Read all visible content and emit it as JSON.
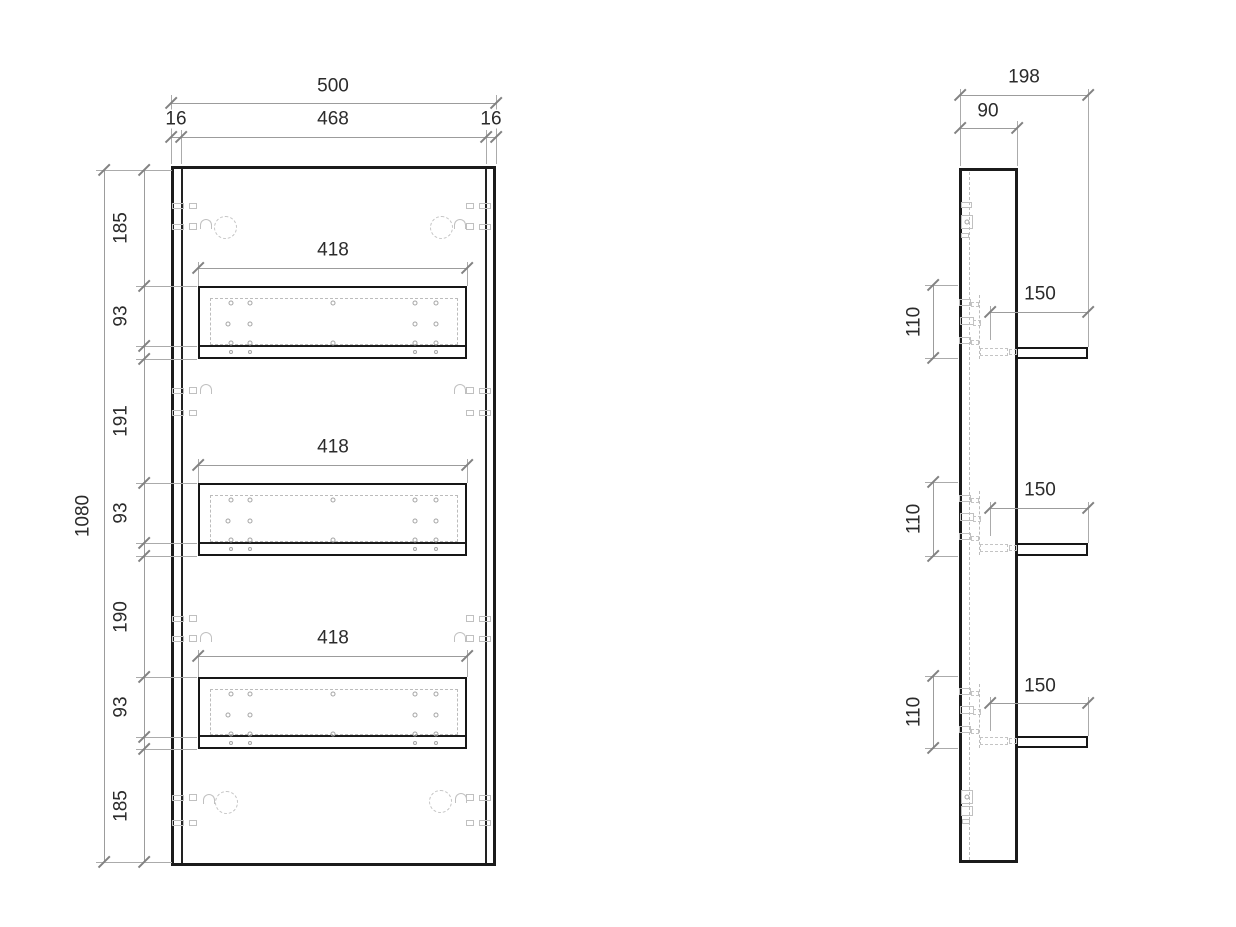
{
  "front_view": {
    "width_total": "500",
    "width_inner": "468",
    "edge_left": "16",
    "edge_right": "16",
    "shelf_widths": [
      "418",
      "418",
      "418"
    ],
    "height_total": "1080",
    "height_chain": [
      "185",
      "93",
      "191",
      "93",
      "190",
      "93",
      "185"
    ]
  },
  "side_view": {
    "depth_total": "198",
    "panel_width": "90",
    "shelf_depths": [
      "150",
      "150",
      "150"
    ],
    "shelf_heights": [
      "110",
      "110",
      "110"
    ]
  }
}
